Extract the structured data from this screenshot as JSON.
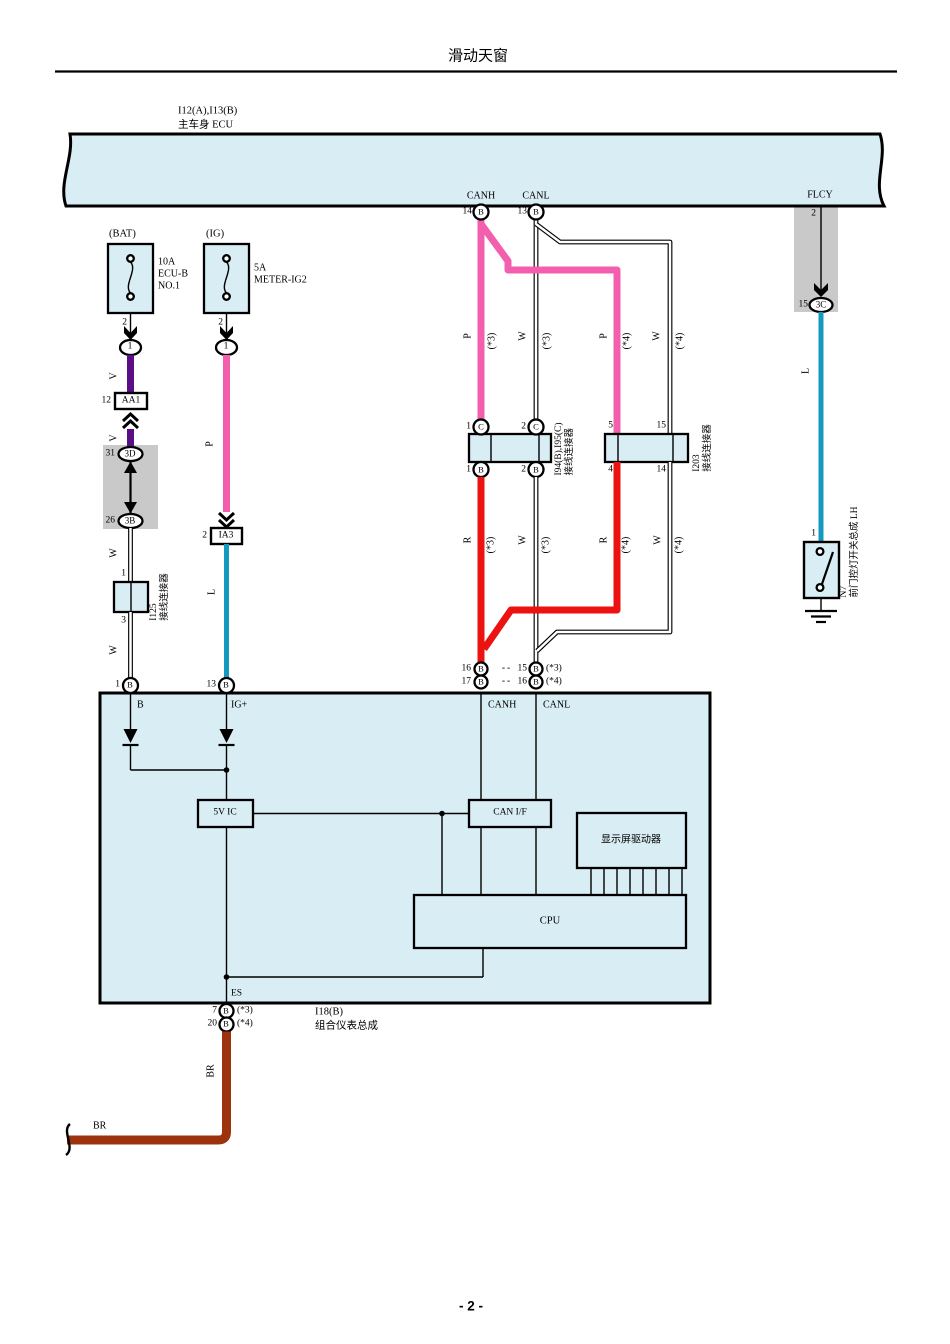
{
  "colors": {
    "block": "#d9edf4",
    "gray": "#c9c9c9",
    "pink": "#f35fae",
    "purple": "#5a0f87",
    "teal": "#1499c1",
    "red": "#ec1212",
    "brown": "#9c330e"
  },
  "title": "滑动天窗",
  "page_number": "- 2 -",
  "codes": {
    "b": "B",
    "c": "C"
  },
  "wires": {
    "v": "V",
    "p": "P",
    "w": "W",
    "l": "L",
    "r": "R",
    "br": "BR"
  },
  "variants": {
    "v3": "(*3)",
    "v4": "(*4)",
    "dash": "--"
  },
  "ecu": {
    "ref": "I12(A),I13(B)",
    "name": "主车身 ECU",
    "canh": "CANH",
    "canl": "CANL",
    "flcy": "FLCY",
    "pin_canh": "14",
    "pin_canl": "13",
    "pin_flcy": "2",
    "conn3c": {
      "num": "15",
      "code": "3C"
    }
  },
  "fuse_bat": {
    "bus": "(BAT)",
    "rating": "10A",
    "name1": "ECU-B",
    "name2": "NO.1",
    "pin": "2",
    "oval": "1"
  },
  "fuse_ig": {
    "bus": "(IG)",
    "rating": "5A",
    "name1": "METER-IG2",
    "pin": "2",
    "oval": "1"
  },
  "bat_branch": {
    "aa1": {
      "num": "12",
      "code": "AA1"
    },
    "c3d": {
      "num": "31",
      "code": "3D"
    },
    "c3b": {
      "num": "26",
      "code": "3B"
    },
    "i125": {
      "pin_in": "1",
      "pin_out": "3",
      "ref": "I125",
      "name": "接线连接器"
    },
    "meter_pin": "1"
  },
  "ig_branch": {
    "ia3": {
      "num": "2",
      "code": "IA3"
    },
    "meter_pin": "13"
  },
  "junction1": {
    "ref": "I94(B),I95(C)",
    "name": "接线连接器",
    "t1": "1",
    "t2": "2",
    "b1": "1",
    "b2": "2"
  },
  "junction2": {
    "ref": "I203",
    "name": "接线连接器",
    "t1": "5",
    "t2": "15",
    "b1": "4",
    "b2": "14"
  },
  "can_entry": {
    "r1a": "16",
    "r1b": "15",
    "r2a": "17",
    "r2b": "16"
  },
  "door_switch": {
    "pin": "1",
    "ref": "N7",
    "name": "前门控灯开关总成 LH"
  },
  "meter": {
    "ref": "I18(B)",
    "name": "组合仪表总成",
    "b": "B",
    "ig": "IG+",
    "canh": "CANH",
    "canl": "CANL",
    "reg": "5V IC",
    "canif": "CAN I/F",
    "display": "显示屏驱动器",
    "cpu": "CPU",
    "es": "ES",
    "pin_es1": "7",
    "pin_es2": "20"
  }
}
